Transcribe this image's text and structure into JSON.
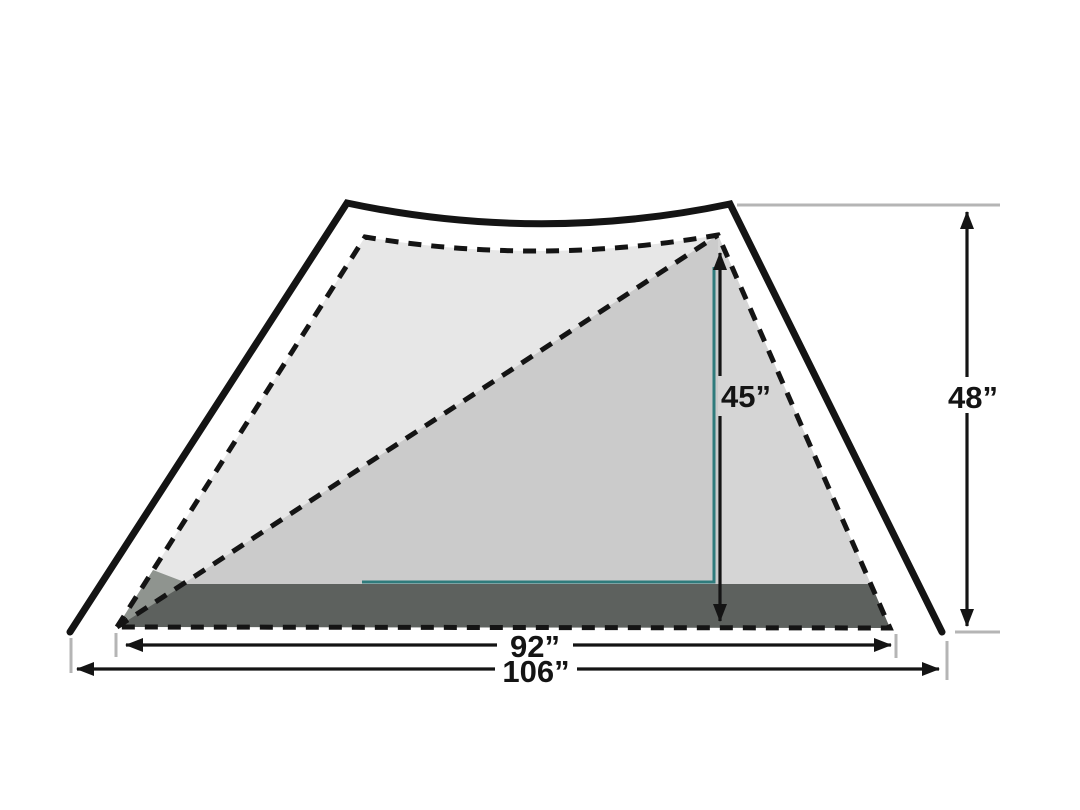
{
  "diagram": {
    "name": "Tent cross-section with interior and exterior dimensions",
    "labels": {
      "inner_height": "45”",
      "outer_height": "48”",
      "inner_width": "92”",
      "outer_width": "106”"
    },
    "measurements": {
      "inner_height_in": 45,
      "outer_height_in": 48,
      "inner_width_in": 92,
      "outer_width_in": 106
    },
    "colors": {
      "background": "#ffffff",
      "line": "#141414",
      "ref": "#b5b5b5",
      "teal": "#2f7b7c",
      "canvas_light": "#e7e7e7",
      "canvas_mid": "#cbcbcb",
      "canvas_right": "#d5d5d5",
      "floor": "#5d615e",
      "vestibule": "#8f948f"
    }
  }
}
